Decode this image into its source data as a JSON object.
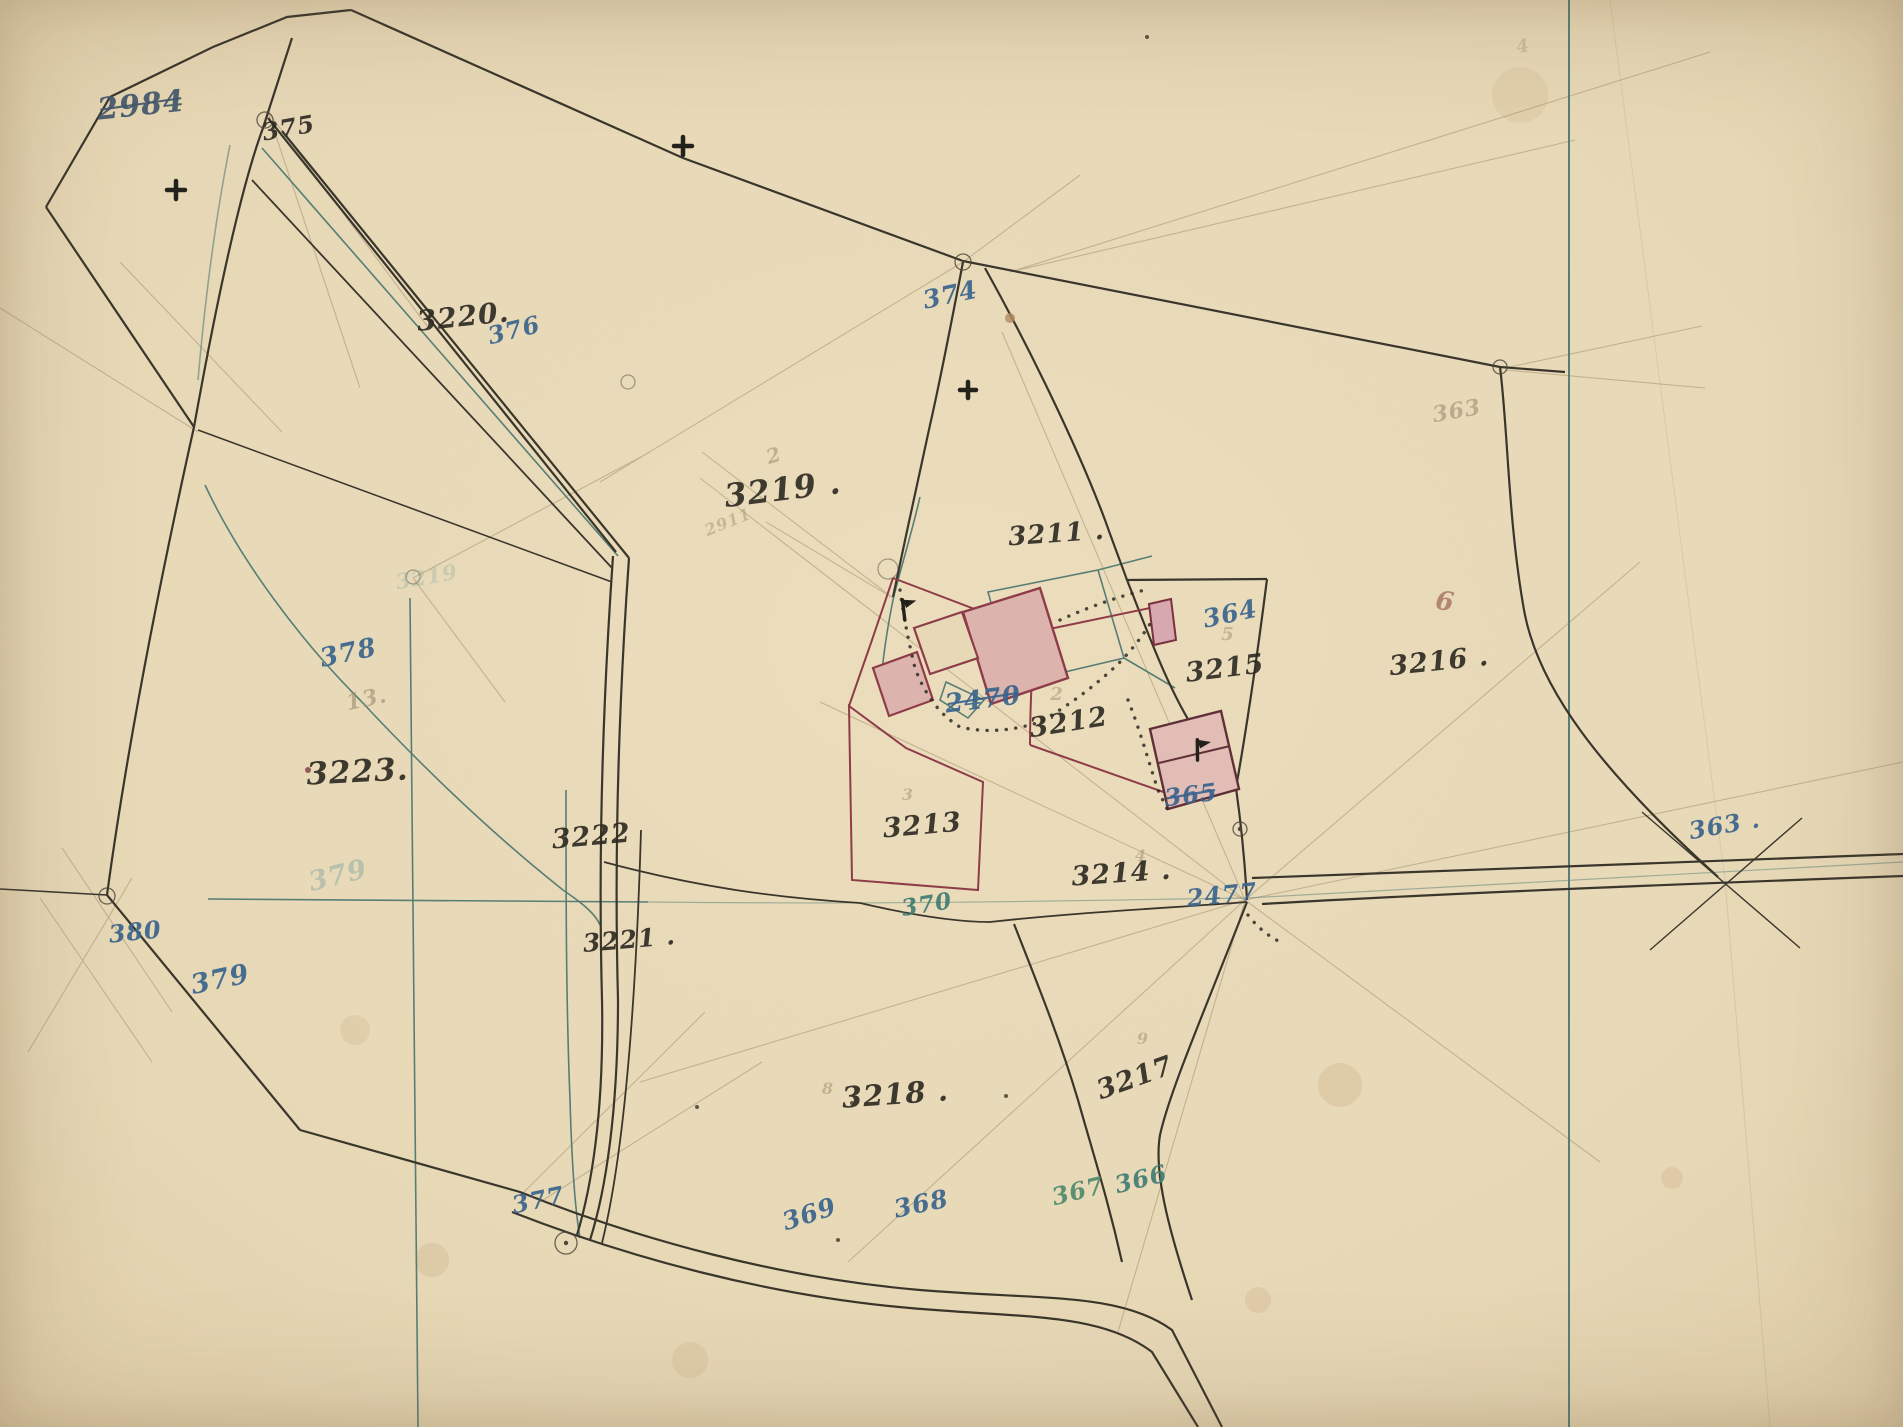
{
  "map": {
    "type": "hand-drawn cadastral survey map",
    "paper_color": "#e7d8b6",
    "ink_colors": {
      "black": "#2f2c23",
      "blueblack": "#41566b",
      "blue": "#39648c",
      "teal": "#3f7c74",
      "green": "#4f8a6d",
      "fadedteal": "#86aaa0",
      "pencil": "#9b8c6e",
      "faintred": "#a06a5a"
    },
    "line_colors": {
      "boundary_ink": "#3a362c",
      "survey_teal": "#577e75",
      "building_red": "#8e3c49",
      "building_dark": "#5f3038",
      "building_fill": "#ddb3ad",
      "pencil": "#a5926f"
    },
    "labels": [
      {
        "text": "2984",
        "x": 142,
        "y": 115,
        "size": 30,
        "ink": "blueblack",
        "rot": -6,
        "strike": true
      },
      {
        "text": "375",
        "x": 290,
        "y": 136,
        "size": 24,
        "ink": "black",
        "rot": -10
      },
      {
        "text": "3220.",
        "x": 464,
        "y": 326,
        "size": 28,
        "ink": "black",
        "rot": -6
      },
      {
        "text": "376",
        "x": 516,
        "y": 338,
        "size": 24,
        "ink": "blue",
        "rot": -14
      },
      {
        "text": "374",
        "x": 952,
        "y": 303,
        "size": 25,
        "ink": "blue",
        "rot": -12
      },
      {
        "text": "3219 .",
        "x": 784,
        "y": 500,
        "size": 32,
        "ink": "black",
        "rot": -7
      },
      {
        "text": "2",
        "x": 776,
        "y": 462,
        "size": 20,
        "ink": "pencil",
        "rot": -18,
        "opacity": 0.55
      },
      {
        "text": "2911",
        "x": 730,
        "y": 527,
        "size": 16,
        "ink": "pencil",
        "rot": -22,
        "opacity": 0.45
      },
      {
        "text": "3211 .",
        "x": 1057,
        "y": 542,
        "size": 26,
        "ink": "black",
        "rot": -4
      },
      {
        "text": "363",
        "x": 1458,
        "y": 418,
        "size": 22,
        "ink": "pencil",
        "rot": -10,
        "opacity": 0.6
      },
      {
        "text": "4",
        "x": 1524,
        "y": 52,
        "size": 18,
        "ink": "pencil",
        "rot": -10,
        "opacity": 0.35
      },
      {
        "text": "364",
        "x": 1232,
        "y": 622,
        "size": 25,
        "ink": "blue",
        "rot": -12
      },
      {
        "text": "5",
        "x": 1228,
        "y": 640,
        "size": 18,
        "ink": "pencil",
        "rot": 0,
        "opacity": 0.5
      },
      {
        "text": "3215",
        "x": 1226,
        "y": 677,
        "size": 27,
        "ink": "black",
        "rot": -7
      },
      {
        "text": "6",
        "x": 1444,
        "y": 610,
        "size": 26,
        "ink": "faintred",
        "rot": 8,
        "opacity": 0.75
      },
      {
        "text": "3216 .",
        "x": 1440,
        "y": 670,
        "size": 27,
        "ink": "black",
        "rot": -6
      },
      {
        "text": "378",
        "x": 350,
        "y": 661,
        "size": 26,
        "ink": "blue",
        "rot": -12
      },
      {
        "text": "13.",
        "x": 368,
        "y": 706,
        "size": 22,
        "ink": "pencil",
        "rot": -12,
        "opacity": 0.6
      },
      {
        "text": "3223.",
        "x": 358,
        "y": 782,
        "size": 31,
        "ink": "black",
        "rot": -3
      },
      {
        "text": "3219",
        "x": 428,
        "y": 584,
        "size": 21,
        "ink": "fadedteal",
        "rot": -10,
        "opacity": 0.32
      },
      {
        "text": "3222",
        "x": 592,
        "y": 845,
        "size": 27,
        "ink": "black",
        "rot": -5
      },
      {
        "text": "3221 .",
        "x": 630,
        "y": 948,
        "size": 25,
        "ink": "black",
        "rot": -5
      },
      {
        "text": "2470",
        "x": 984,
        "y": 708,
        "size": 26,
        "ink": "blue",
        "rot": -7,
        "strike": true
      },
      {
        "text": "2",
        "x": 1057,
        "y": 700,
        "size": 18,
        "ink": "pencil",
        "rot": 0,
        "opacity": 0.5
      },
      {
        "text": "3212",
        "x": 1070,
        "y": 731,
        "size": 27,
        "ink": "black",
        "rot": -9
      },
      {
        "text": "3",
        "x": 908,
        "y": 800,
        "size": 16,
        "ink": "pencil",
        "rot": 0,
        "opacity": 0.5
      },
      {
        "text": "3213",
        "x": 923,
        "y": 834,
        "size": 27,
        "ink": "black",
        "rot": -5
      },
      {
        "text": "4",
        "x": 1141,
        "y": 861,
        "size": 16,
        "ink": "pencil",
        "rot": 0,
        "opacity": 0.5
      },
      {
        "text": "3214 .",
        "x": 1122,
        "y": 882,
        "size": 27,
        "ink": "black",
        "rot": -4
      },
      {
        "text": "370",
        "x": 928,
        "y": 912,
        "size": 23,
        "ink": "teal",
        "rot": -9
      },
      {
        "text": "2477",
        "x": 1223,
        "y": 903,
        "size": 24,
        "ink": "blue",
        "rot": -6
      },
      {
        "text": "365",
        "x": 1192,
        "y": 803,
        "size": 24,
        "ink": "blue",
        "rot": -7,
        "strike": true
      },
      {
        "text": "363 .",
        "x": 1726,
        "y": 833,
        "size": 24,
        "ink": "blue",
        "rot": -10
      },
      {
        "text": "380",
        "x": 136,
        "y": 940,
        "size": 24,
        "ink": "blue",
        "rot": -6
      },
      {
        "text": "379",
        "x": 222,
        "y": 988,
        "size": 27,
        "ink": "blue",
        "rot": -12
      },
      {
        "text": "379",
        "x": 340,
        "y": 884,
        "size": 27,
        "ink": "fadedteal",
        "rot": -14,
        "opacity": 0.5
      },
      {
        "text": "8",
        "x": 828,
        "y": 1094,
        "size": 16,
        "ink": "pencil",
        "rot": 0,
        "opacity": 0.5
      },
      {
        "text": "3218 .",
        "x": 896,
        "y": 1104,
        "size": 29,
        "ink": "black",
        "rot": -4
      },
      {
        "text": "9",
        "x": 1143,
        "y": 1044,
        "size": 16,
        "ink": "pencil",
        "rot": 0,
        "opacity": 0.5
      },
      {
        "text": "3217",
        "x": 1138,
        "y": 1086,
        "size": 27,
        "ink": "black",
        "rot": -20
      },
      {
        "text": "377",
        "x": 540,
        "y": 1208,
        "size": 24,
        "ink": "blue",
        "rot": -12
      },
      {
        "text": "369",
        "x": 812,
        "y": 1222,
        "size": 25,
        "ink": "blue",
        "rot": -18
      },
      {
        "text": "368",
        "x": 923,
        "y": 1212,
        "size": 25,
        "ink": "blue",
        "rot": -12
      },
      {
        "text": "367",
        "x": 1080,
        "y": 1199,
        "size": 24,
        "ink": "green",
        "rot": -14
      },
      {
        "text": "366",
        "x": 1143,
        "y": 1187,
        "size": 24,
        "ink": "teal",
        "rot": -14
      }
    ],
    "symbols": {
      "crosses": [
        {
          "x": 176,
          "y": 190,
          "s": 9
        },
        {
          "x": 683,
          "y": 146,
          "s": 9
        },
        {
          "x": 968,
          "y": 390,
          "s": 8
        }
      ],
      "flags": [
        {
          "x": 903,
          "y": 608,
          "rot": -18
        },
        {
          "x": 1197,
          "y": 748,
          "rot": -12
        }
      ],
      "circles": [
        {
          "x": 265,
          "y": 120,
          "r": 8
        },
        {
          "x": 963,
          "y": 262,
          "r": 8
        },
        {
          "x": 1500,
          "y": 367,
          "r": 7
        },
        {
          "x": 107,
          "y": 896,
          "r": 8
        },
        {
          "x": 566,
          "y": 1243,
          "r": 11,
          "dot": true
        },
        {
          "x": 1240,
          "y": 829,
          "r": 7,
          "dot": true
        },
        {
          "x": 888,
          "y": 569,
          "r": 10,
          "faint": true
        },
        {
          "x": 628,
          "y": 382,
          "r": 7,
          "faint": true
        },
        {
          "x": 413,
          "y": 577,
          "r": 7,
          "faint": true
        }
      ],
      "specks": [
        {
          "x": 1147,
          "y": 37,
          "r": 2,
          "c": "#3a362c"
        },
        {
          "x": 1010,
          "y": 318,
          "r": 5,
          "c": "#b08a62"
        },
        {
          "x": 308,
          "y": 770,
          "r": 3,
          "c": "#7c3b40"
        },
        {
          "x": 852,
          "y": 1103,
          "r": 2,
          "c": "#3a362c"
        },
        {
          "x": 1006,
          "y": 1096,
          "r": 2,
          "c": "#3a362c"
        },
        {
          "x": 697,
          "y": 1107,
          "r": 2,
          "c": "#3a362c"
        },
        {
          "x": 838,
          "y": 1240,
          "r": 2,
          "c": "#3a362c"
        }
      ]
    },
    "stains": [
      {
        "x": 1340,
        "y": 1085,
        "r": 22,
        "o": 0.14
      },
      {
        "x": 432,
        "y": 1260,
        "r": 17,
        "o": 0.13
      },
      {
        "x": 1258,
        "y": 1300,
        "r": 13,
        "o": 0.12
      },
      {
        "x": 1672,
        "y": 1178,
        "r": 11,
        "o": 0.12
      },
      {
        "x": 355,
        "y": 1030,
        "r": 15,
        "o": 0.1
      },
      {
        "x": 1520,
        "y": 95,
        "r": 28,
        "o": 0.09
      },
      {
        "x": 690,
        "y": 1360,
        "r": 18,
        "o": 0.1
      }
    ]
  }
}
